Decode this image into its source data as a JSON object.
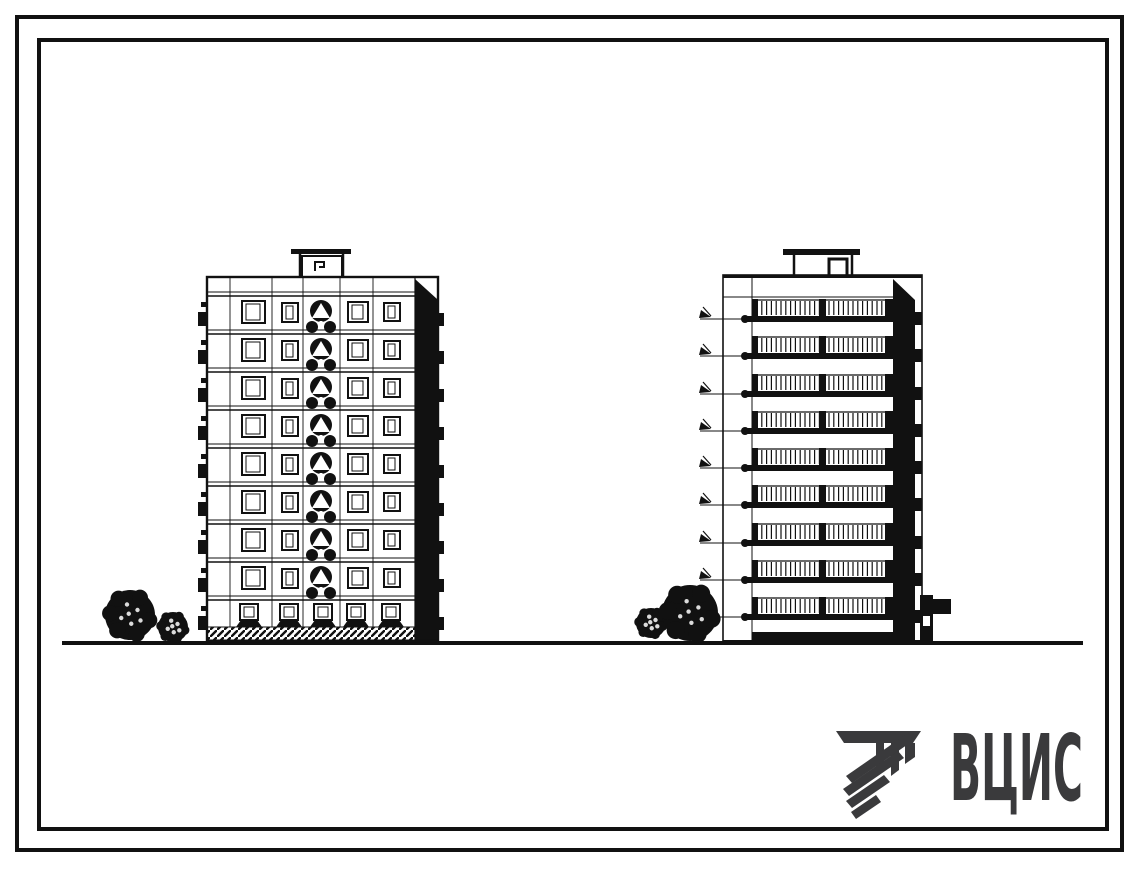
{
  "colors": {
    "ink": "#111111",
    "logo": "#3a3a3c",
    "background": "#ffffff"
  },
  "logo": {
    "text": "ВЦИС",
    "icon": "hatched-beam-logo-icon"
  },
  "drawing": {
    "left_building": {
      "view": "front-elevation",
      "upper_floors": 8,
      "ground_floor_windows": 5,
      "stair_column_motifs": 8,
      "window_bays": 4
    },
    "right_building": {
      "view": "balcony-side-elevation",
      "balcony_rows": 9,
      "level_marks": 9
    },
    "shrubs": {
      "left_group": 2,
      "right_group": 2
    }
  }
}
